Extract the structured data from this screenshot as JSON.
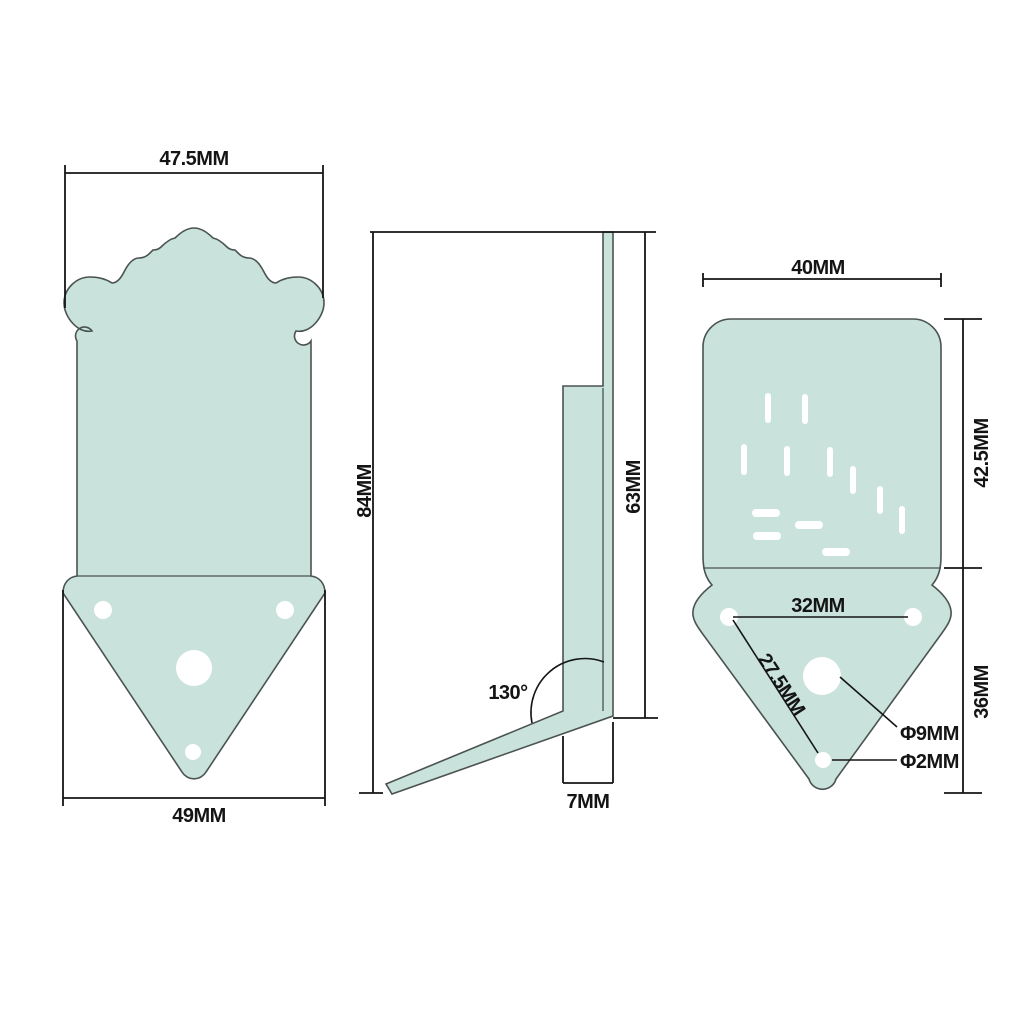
{
  "colors": {
    "background": "#ffffff",
    "part_fill": "#c9e2db",
    "part_outline": "#4a5350",
    "dimension_line": "#151515"
  },
  "views": {
    "front": {
      "labels": {
        "top_width": "47.5MM",
        "bottom_width": "49MM"
      }
    },
    "side": {
      "labels": {
        "total_height": "84MM",
        "upper_height": "63MM",
        "bend_angle": "130°",
        "foot_width": "7MM"
      }
    },
    "back": {
      "labels": {
        "top_width": "40MM",
        "cover_height": "42.5MM",
        "bracket_height": "36MM",
        "hole_spacing": "32MM",
        "hole_diagonal": "27.5MM",
        "center_hole_diameter": "Φ9MM",
        "small_hole_diameter": "Φ2MM"
      }
    }
  }
}
